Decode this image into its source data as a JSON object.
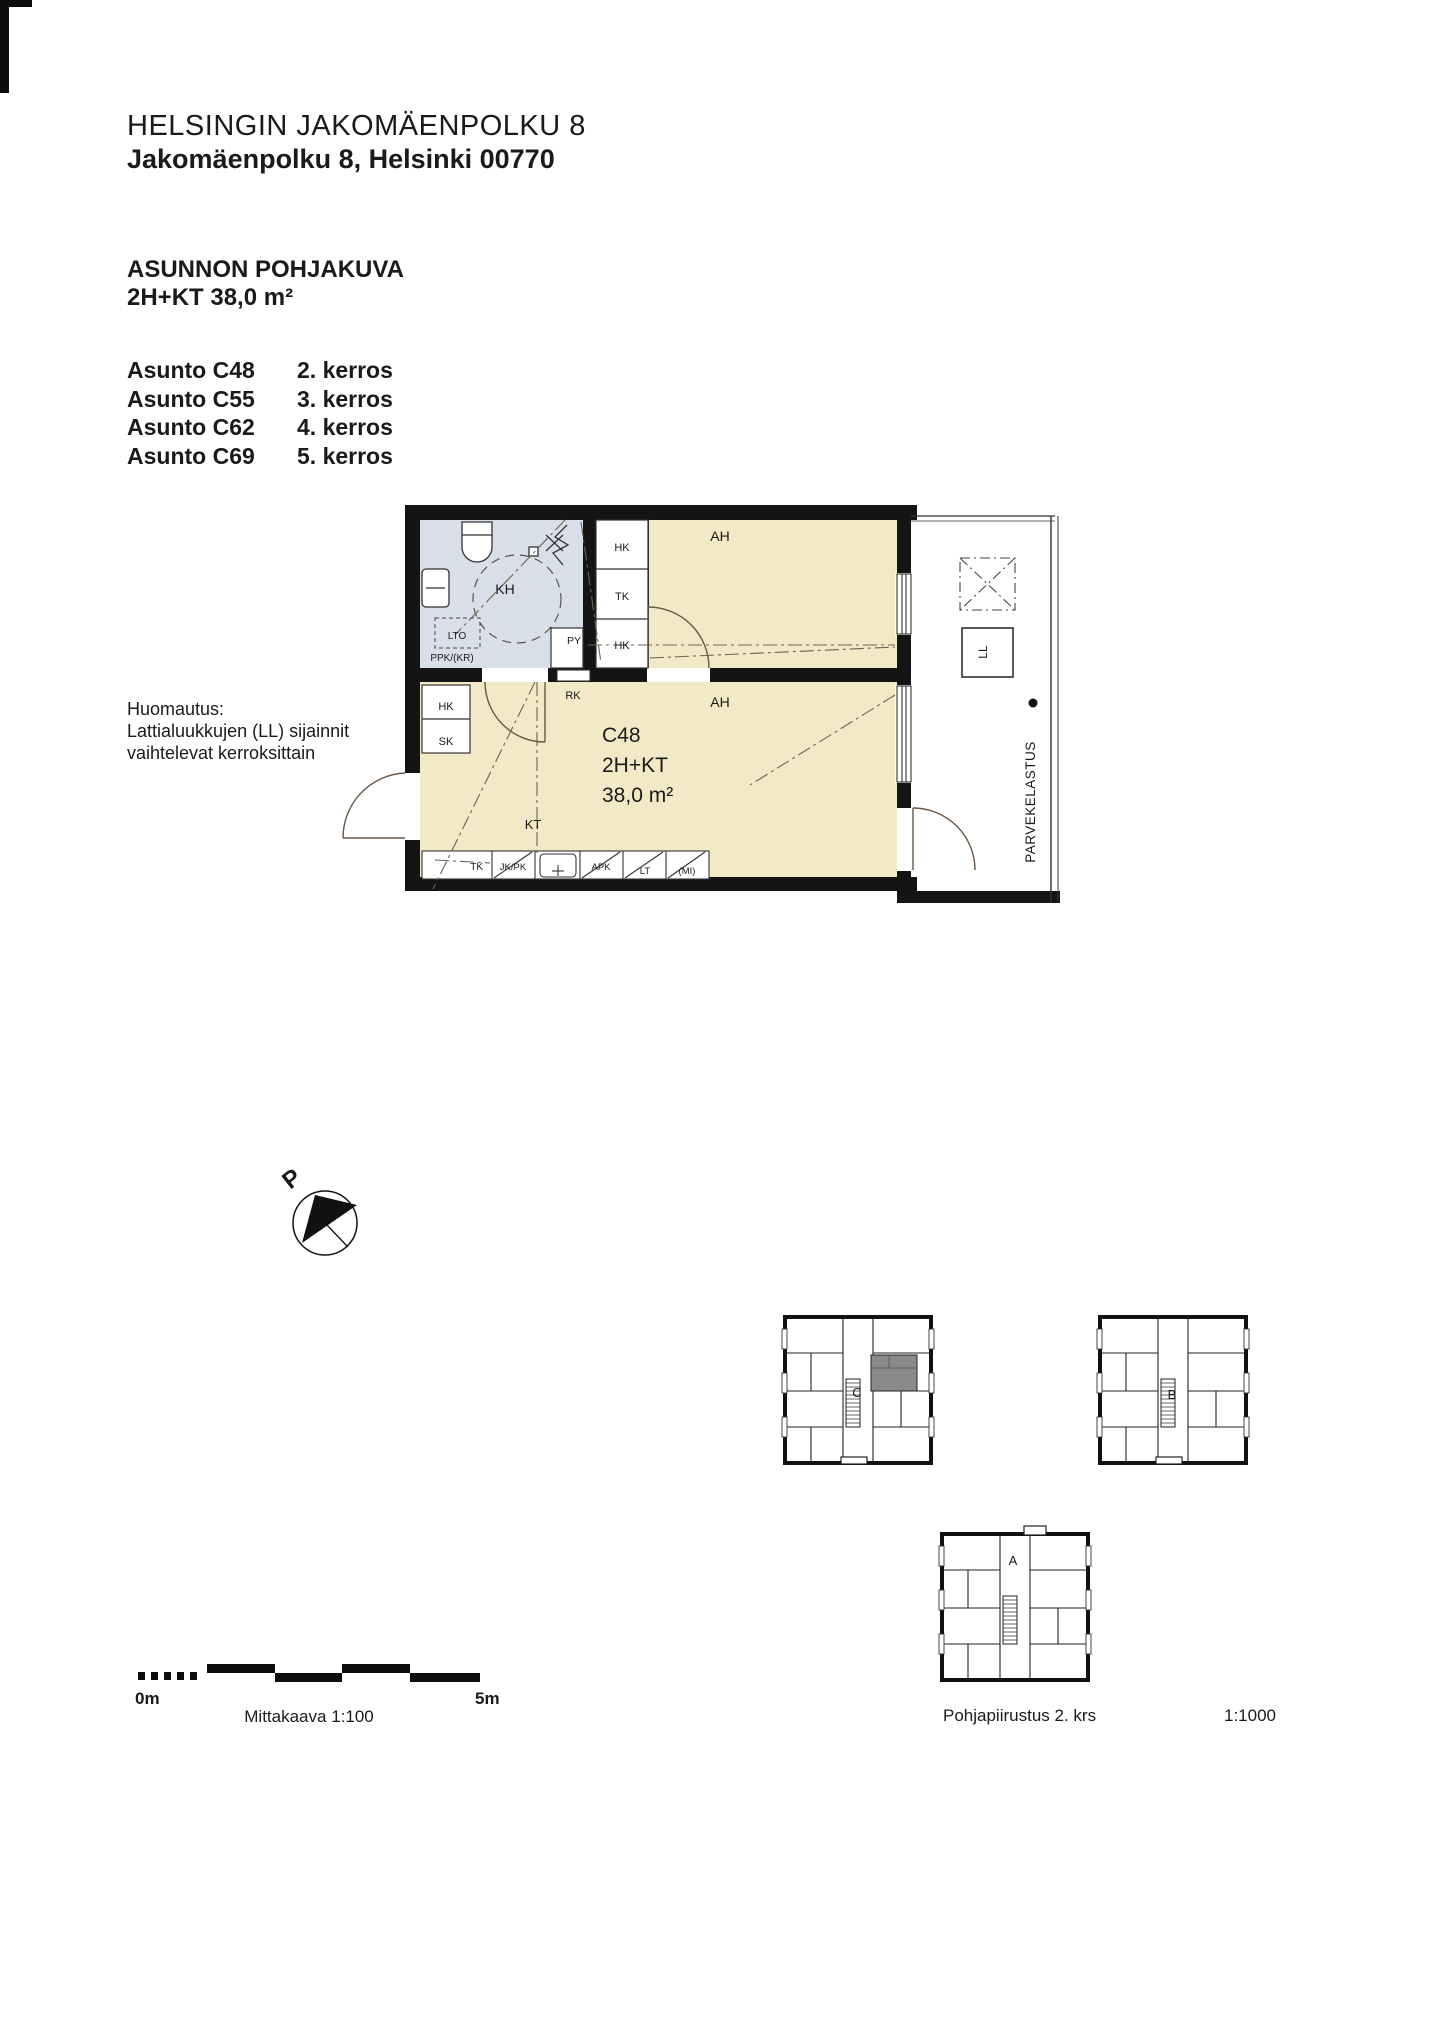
{
  "header": {
    "title": "HELSINGIN JAKOMÄENPOLKU 8",
    "address": "Jakomäenpolku 8, Helsinki 00770",
    "drawing_type": "ASUNNON POHJAKUVA",
    "apartment_type": "2H+KT 38,0 m²"
  },
  "apartment_list": [
    {
      "name": "Asunto C48",
      "floor": "2. kerros"
    },
    {
      "name": "Asunto C55",
      "floor": "3. kerros"
    },
    {
      "name": "Asunto C62",
      "floor": "4. kerros"
    },
    {
      "name": "Asunto C69",
      "floor": "5. kerros"
    }
  ],
  "note": {
    "line1": "Huomautus:",
    "line2": "Lattialuukkujen (LL) sijainnit",
    "line3": "vaihtelevat kerroksittain"
  },
  "floor_plan": {
    "id": "C48",
    "type": "2H+KT",
    "area": "38,0 m²",
    "labels": {
      "ah": "AH",
      "kh": "KH",
      "kt": "KT",
      "hk": "HK",
      "tk": "TK",
      "sk": "SK",
      "rk": "RK",
      "py": "PY",
      "lto": "LTO",
      "ppk_kr": "PPK/(KR)",
      "jk_pk": "JK/PK",
      "apk": "APK",
      "lt": "LT",
      "mi": "(MI)",
      "ll": "LL",
      "balcony_loading": "PARVEKELASTUS"
    },
    "colors": {
      "room_fill": "#f2e9c6",
      "wet_room_fill": "#d9dfe9",
      "wall": "#141414",
      "key_plan_highlight": "#8a8a8a"
    }
  },
  "compass": {
    "north_label": "P"
  },
  "scale_bar": {
    "zero": "0m",
    "five": "5m",
    "caption": "Mittakaava 1:100"
  },
  "key_plans": {
    "building_c": "C",
    "building_b": "B",
    "building_a": "A",
    "caption": "Pohjapiirustus 2. krs",
    "scale": "1:1000"
  }
}
